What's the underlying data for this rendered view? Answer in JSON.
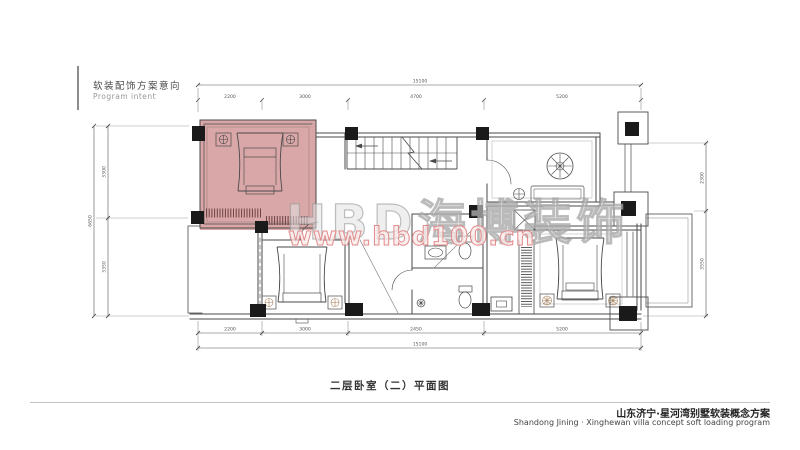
{
  "header": {
    "title_cn": "软装配饰方案意向",
    "title_en": "Program intent"
  },
  "watermark": {
    "brand": "HBD海博装饰",
    "url": "www.hbd100.cn"
  },
  "footer": {
    "drawing_title": "二层卧室（二）平面图",
    "project_cn": "山东济宁·星河湾别墅软装概念方案",
    "project_en": "Shandong Jining · Xinghewan villa concept soft loading program"
  },
  "plan": {
    "highlighted_room": "second-floor-bedroom-2",
    "dims": {
      "top_total": "15100",
      "top_segments": [
        "2200",
        "3000",
        "4700",
        "5200"
      ],
      "bottom_segments": [
        "2200",
        "3000",
        "2450",
        "5200"
      ],
      "bottom_total": "15100",
      "left_total": "6650",
      "left_segments": [
        "3300",
        "3350"
      ],
      "right_segments": [
        "2300",
        "3550"
      ]
    }
  },
  "colors": {
    "highlight": "#d9a7a7",
    "watermark_gray": "#bdbdbd",
    "watermark_pink": "#e28a8a",
    "ink": "#4a4a4a"
  }
}
